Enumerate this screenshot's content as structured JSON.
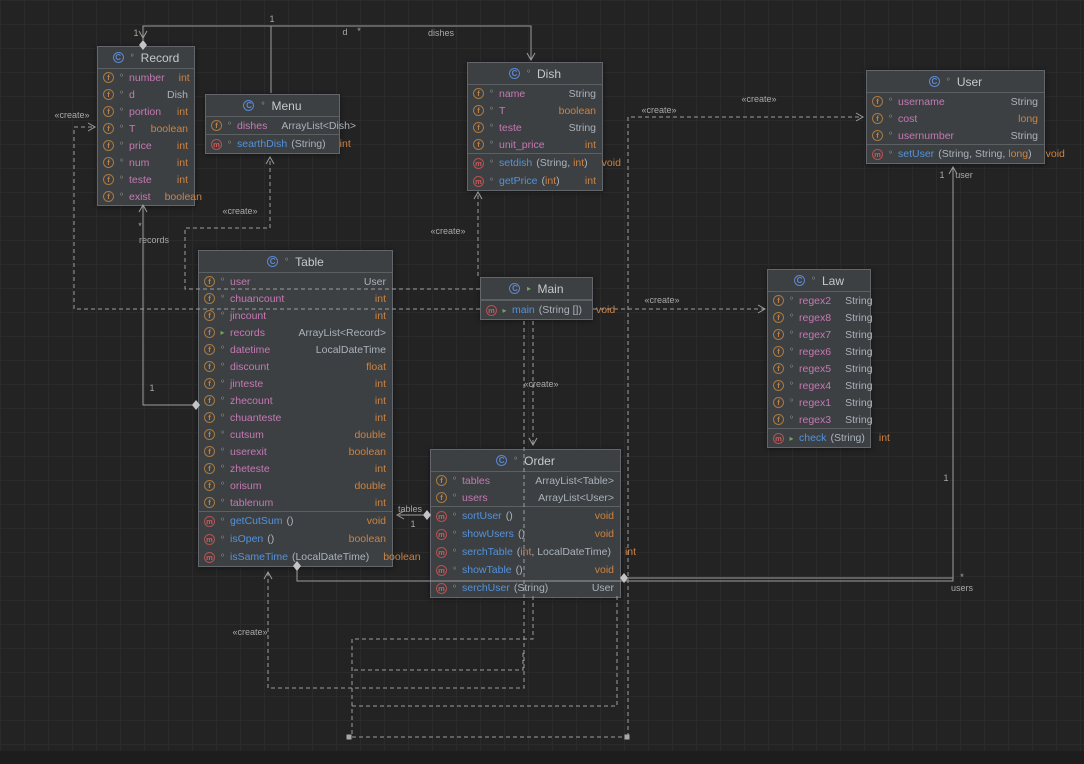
{
  "canvas": {
    "width": 1084,
    "height": 764
  },
  "colors": {
    "background": "#232323",
    "grid_line": "#2b2b2b",
    "node_fill": "#3d4042",
    "node_border": "#63666a",
    "field_name": "#c678b5",
    "method_name": "#5292dc",
    "primitive_type": "#cc8242",
    "class_type": "#a9b2bc",
    "edge": "#9d9d9d",
    "edge_label": "#a8a8a8",
    "field_icon": "#c08048",
    "method_icon": "#cd5a5a",
    "class_icon": "#5e87cf",
    "green_marker": "#77a35e"
  },
  "primitives": [
    "int",
    "boolean",
    "long",
    "float",
    "double",
    "void"
  ],
  "classes": [
    {
      "id": "record",
      "title": "Record",
      "x": 97,
      "y": 46,
      "w": 98,
      "green": false,
      "fields": [
        {
          "name": "number",
          "type": "int"
        },
        {
          "name": "d",
          "type": "Dish"
        },
        {
          "name": "portion",
          "type": "int"
        },
        {
          "name": "T",
          "type": "boolean"
        },
        {
          "name": "price",
          "type": "int"
        },
        {
          "name": "num",
          "type": "int"
        },
        {
          "name": "teste",
          "type": "int"
        },
        {
          "name": "exist",
          "type": "boolean"
        }
      ],
      "methods": []
    },
    {
      "id": "menu",
      "title": "Menu",
      "x": 205,
      "y": 94,
      "w": 135,
      "green": false,
      "fields": [
        {
          "name": "dishes",
          "type": "ArrayList<Dish>"
        }
      ],
      "methods": [
        {
          "name": "searthDish",
          "params": [
            "String"
          ],
          "type": "int"
        }
      ]
    },
    {
      "id": "dish",
      "title": "Dish",
      "x": 467,
      "y": 62,
      "w": 136,
      "green": false,
      "fields": [
        {
          "name": "name",
          "type": "String"
        },
        {
          "name": "T",
          "type": "boolean"
        },
        {
          "name": "teste",
          "type": "String"
        },
        {
          "name": "unit_price",
          "type": "int"
        }
      ],
      "methods": [
        {
          "name": "setdish",
          "params": [
            "String",
            "int"
          ],
          "type": "void"
        },
        {
          "name": "getPrice",
          "params": [
            "int"
          ],
          "type": "int"
        }
      ]
    },
    {
      "id": "user",
      "title": "User",
      "x": 866,
      "y": 70,
      "w": 179,
      "green": false,
      "fields": [
        {
          "name": "username",
          "type": "String"
        },
        {
          "name": "cost",
          "type": "long"
        },
        {
          "name": "usernumber",
          "type": "String"
        }
      ],
      "methods": [
        {
          "name": "setUser",
          "params": [
            "String",
            "String",
            "long"
          ],
          "type": "void"
        }
      ]
    },
    {
      "id": "table",
      "title": "Table",
      "x": 198,
      "y": 250,
      "w": 195,
      "green": false,
      "fields": [
        {
          "name": "user",
          "type": "User"
        },
        {
          "name": "chuancount",
          "type": "int"
        },
        {
          "name": "jincount",
          "type": "int"
        },
        {
          "name": "records",
          "type": "ArrayList<Record>",
          "green": true
        },
        {
          "name": "datetime",
          "type": "LocalDateTime"
        },
        {
          "name": "discount",
          "type": "float"
        },
        {
          "name": "jinteste",
          "type": "int"
        },
        {
          "name": "zhecount",
          "type": "int"
        },
        {
          "name": "chuanteste",
          "type": "int"
        },
        {
          "name": "cutsum",
          "type": "double"
        },
        {
          "name": "userexit",
          "type": "boolean"
        },
        {
          "name": "zheteste",
          "type": "int"
        },
        {
          "name": "orisum",
          "type": "double"
        },
        {
          "name": "tablenum",
          "type": "int"
        }
      ],
      "methods": [
        {
          "name": "getCutSum",
          "params": [],
          "type": "void"
        },
        {
          "name": "isOpen",
          "params": [],
          "type": "boolean"
        },
        {
          "name": "isSameTime",
          "params": [
            "LocalDateTime"
          ],
          "type": "boolean"
        }
      ]
    },
    {
      "id": "main",
      "title": "Main",
      "x": 480,
      "y": 277,
      "w": 113,
      "green": true,
      "fields": [],
      "methods": [
        {
          "name": "main",
          "params": [
            "String []"
          ],
          "type": "void",
          "green": true
        }
      ]
    },
    {
      "id": "law",
      "title": "Law",
      "x": 767,
      "y": 269,
      "w": 104,
      "green": false,
      "fields": [
        {
          "name": "regex2",
          "type": "String"
        },
        {
          "name": "regex8",
          "type": "String"
        },
        {
          "name": "regex7",
          "type": "String"
        },
        {
          "name": "regex6",
          "type": "String"
        },
        {
          "name": "regex5",
          "type": "String"
        },
        {
          "name": "regex4",
          "type": "String"
        },
        {
          "name": "regex1",
          "type": "String"
        },
        {
          "name": "regex3",
          "type": "String"
        }
      ],
      "methods": [
        {
          "name": "check",
          "params": [
            "String"
          ],
          "type": "int",
          "green": true
        }
      ]
    },
    {
      "id": "order",
      "title": "Order",
      "x": 430,
      "y": 449,
      "w": 191,
      "green": false,
      "fields": [
        {
          "name": "tables",
          "type": "ArrayList<Table>"
        },
        {
          "name": "users",
          "type": "ArrayList<User>"
        }
      ],
      "methods": [
        {
          "name": "sortUser",
          "params": [],
          "type": "void"
        },
        {
          "name": "showUsers",
          "params": [],
          "type": "void"
        },
        {
          "name": "serchTable",
          "params": [
            "int",
            "LocalDateTime"
          ],
          "type": "int"
        },
        {
          "name": "showTable",
          "params": [],
          "type": "void"
        },
        {
          "name": "serchUser",
          "params": [
            "String"
          ],
          "type": "User"
        }
      ]
    }
  ],
  "edges": [
    {
      "name": "record-dish-d",
      "kind": "solid",
      "points": [
        [
          143,
          40
        ],
        [
          143,
          26
        ],
        [
          531,
          26
        ],
        [
          531,
          59
        ]
      ],
      "markers": [
        {
          "type": "arrow-down",
          "x": 143,
          "y": 38
        },
        {
          "type": "diamond",
          "x": 143,
          "y": 45
        },
        {
          "type": "arrow-down",
          "x": 531,
          "y": 60
        }
      ],
      "labels": [
        {
          "t": "1",
          "x": 136,
          "y": 36
        },
        {
          "t": "1",
          "x": 272,
          "y": 22
        },
        {
          "t": "d",
          "x": 345,
          "y": 35
        },
        {
          "t": "*",
          "x": 359,
          "y": 34
        },
        {
          "t": "dishes",
          "x": 441,
          "y": 36
        }
      ]
    },
    {
      "name": "menu-dish-dishes",
      "kind": "solid",
      "points": [
        [
          271,
          93
        ],
        [
          271,
          26
        ]
      ],
      "markers": [],
      "labels": []
    },
    {
      "name": "main-create-dish",
      "kind": "dashed",
      "points": [
        [
          478,
          276
        ],
        [
          478,
          193
        ]
      ],
      "markers": [
        {
          "type": "arrow-up",
          "x": 478,
          "y": 192
        }
      ],
      "labels": [
        {
          "t": "«create»",
          "x": 448,
          "y": 234
        }
      ]
    },
    {
      "name": "main-create-menu",
      "kind": "dashed",
      "points": [
        [
          480,
          289
        ],
        [
          185,
          289
        ],
        [
          185,
          228
        ],
        [
          270,
          228
        ],
        [
          270,
          158
        ]
      ],
      "markers": [
        {
          "type": "arrow-up",
          "x": 270,
          "y": 157
        }
      ],
      "labels": [
        {
          "t": "«create»",
          "x": 240,
          "y": 214
        }
      ]
    },
    {
      "name": "main-create-record",
      "kind": "dashed",
      "points": [
        [
          480,
          309
        ],
        [
          74,
          309
        ],
        [
          74,
          127
        ],
        [
          93,
          127
        ]
      ],
      "markers": [
        {
          "type": "arrow-right",
          "x": 95,
          "y": 127
        }
      ],
      "labels": [
        {
          "t": "«create»",
          "x": 72,
          "y": 118
        }
      ]
    },
    {
      "name": "main-create-law",
      "kind": "dashed",
      "points": [
        [
          593,
          309
        ],
        [
          764,
          309
        ]
      ],
      "markers": [
        {
          "type": "arrow-right",
          "x": 765,
          "y": 309
        }
      ],
      "labels": [
        {
          "t": "«create»",
          "x": 662,
          "y": 303
        }
      ]
    },
    {
      "name": "create-user",
      "kind": "dashed",
      "points": [
        [
          628,
          737
        ],
        [
          628,
          117
        ],
        [
          862,
          117
        ]
      ],
      "markers": [
        {
          "type": "arrow-right",
          "x": 863,
          "y": 117
        }
      ],
      "labels": [
        {
          "t": "«create»",
          "x": 659,
          "y": 113
        },
        {
          "t": "«create»",
          "x": 759,
          "y": 102
        }
      ]
    },
    {
      "name": "main-create-order",
      "kind": "dashed",
      "points": [
        [
          533,
          321
        ],
        [
          533,
          444
        ]
      ],
      "markers": [
        {
          "type": "arrow-down",
          "x": 533,
          "y": 445
        }
      ],
      "labels": [
        {
          "t": "«create»",
          "x": 541,
          "y": 387
        }
      ]
    },
    {
      "name": "create-table",
      "kind": "dashed",
      "points": [
        [
          524,
          321
        ],
        [
          524,
          688
        ],
        [
          268,
          688
        ],
        [
          268,
          573
        ]
      ],
      "markers": [
        {
          "type": "arrow-up",
          "x": 268,
          "y": 572
        }
      ],
      "labels": [
        {
          "t": "«create»",
          "x": 250,
          "y": 635
        }
      ]
    },
    {
      "name": "web-1",
      "kind": "dashed",
      "points": [
        [
          533,
          596
        ],
        [
          533,
          639
        ],
        [
          352,
          639
        ],
        [
          352,
          737
        ],
        [
          625,
          737
        ]
      ],
      "markers": [
        {
          "type": "sqdot",
          "x": 349,
          "y": 737
        },
        {
          "type": "sqdot",
          "x": 627,
          "y": 737
        }
      ],
      "labels": []
    },
    {
      "name": "web-2",
      "kind": "dashed",
      "points": [
        [
          617,
          596
        ],
        [
          617,
          706
        ],
        [
          352,
          706
        ]
      ],
      "markers": [],
      "labels": []
    },
    {
      "name": "web-3",
      "kind": "dashed",
      "points": [
        [
          523,
          653
        ],
        [
          523,
          670
        ],
        [
          352,
          670
        ]
      ],
      "markers": [],
      "labels": []
    },
    {
      "name": "order-table-tables",
      "kind": "solid",
      "points": [
        [
          426,
          515
        ],
        [
          399,
          515
        ]
      ],
      "markers": [
        {
          "type": "diamond",
          "x": 427,
          "y": 515
        },
        {
          "type": "arrow-left",
          "x": 397,
          "y": 515
        }
      ],
      "labels": [
        {
          "t": "tables",
          "x": 410,
          "y": 512
        },
        {
          "t": "1",
          "x": 413,
          "y": 527
        }
      ]
    },
    {
      "name": "table-user-user",
      "kind": "solid",
      "points": [
        [
          297,
          565
        ],
        [
          297,
          581
        ],
        [
          953,
          581
        ],
        [
          953,
          168
        ]
      ],
      "markers": [
        {
          "type": "diamond",
          "x": 297,
          "y": 566
        },
        {
          "type": "arrow-up",
          "x": 953,
          "y": 167
        }
      ],
      "labels": [
        {
          "t": "1",
          "x": 942,
          "y": 178
        },
        {
          "t": "user",
          "x": 964,
          "y": 178
        },
        {
          "t": "1",
          "x": 946,
          "y": 481
        }
      ]
    },
    {
      "name": "order-user-users",
      "kind": "solid",
      "points": [
        [
          624,
          578
        ],
        [
          953,
          578
        ]
      ],
      "markers": [
        {
          "type": "diamond",
          "x": 624,
          "y": 578
        }
      ],
      "labels": [
        {
          "t": "*",
          "x": 962,
          "y": 580
        },
        {
          "t": "users",
          "x": 962,
          "y": 591
        }
      ]
    },
    {
      "name": "table-record-records",
      "kind": "solid",
      "points": [
        [
          196,
          405
        ],
        [
          143,
          405
        ],
        [
          143,
          206
        ]
      ],
      "markers": [
        {
          "type": "diamond",
          "x": 196,
          "y": 405
        },
        {
          "type": "arrow-up",
          "x": 143,
          "y": 205
        }
      ],
      "labels": [
        {
          "t": "*",
          "x": 140,
          "y": 229
        },
        {
          "t": "records",
          "x": 154,
          "y": 243
        },
        {
          "t": "1",
          "x": 152,
          "y": 391
        }
      ]
    }
  ]
}
